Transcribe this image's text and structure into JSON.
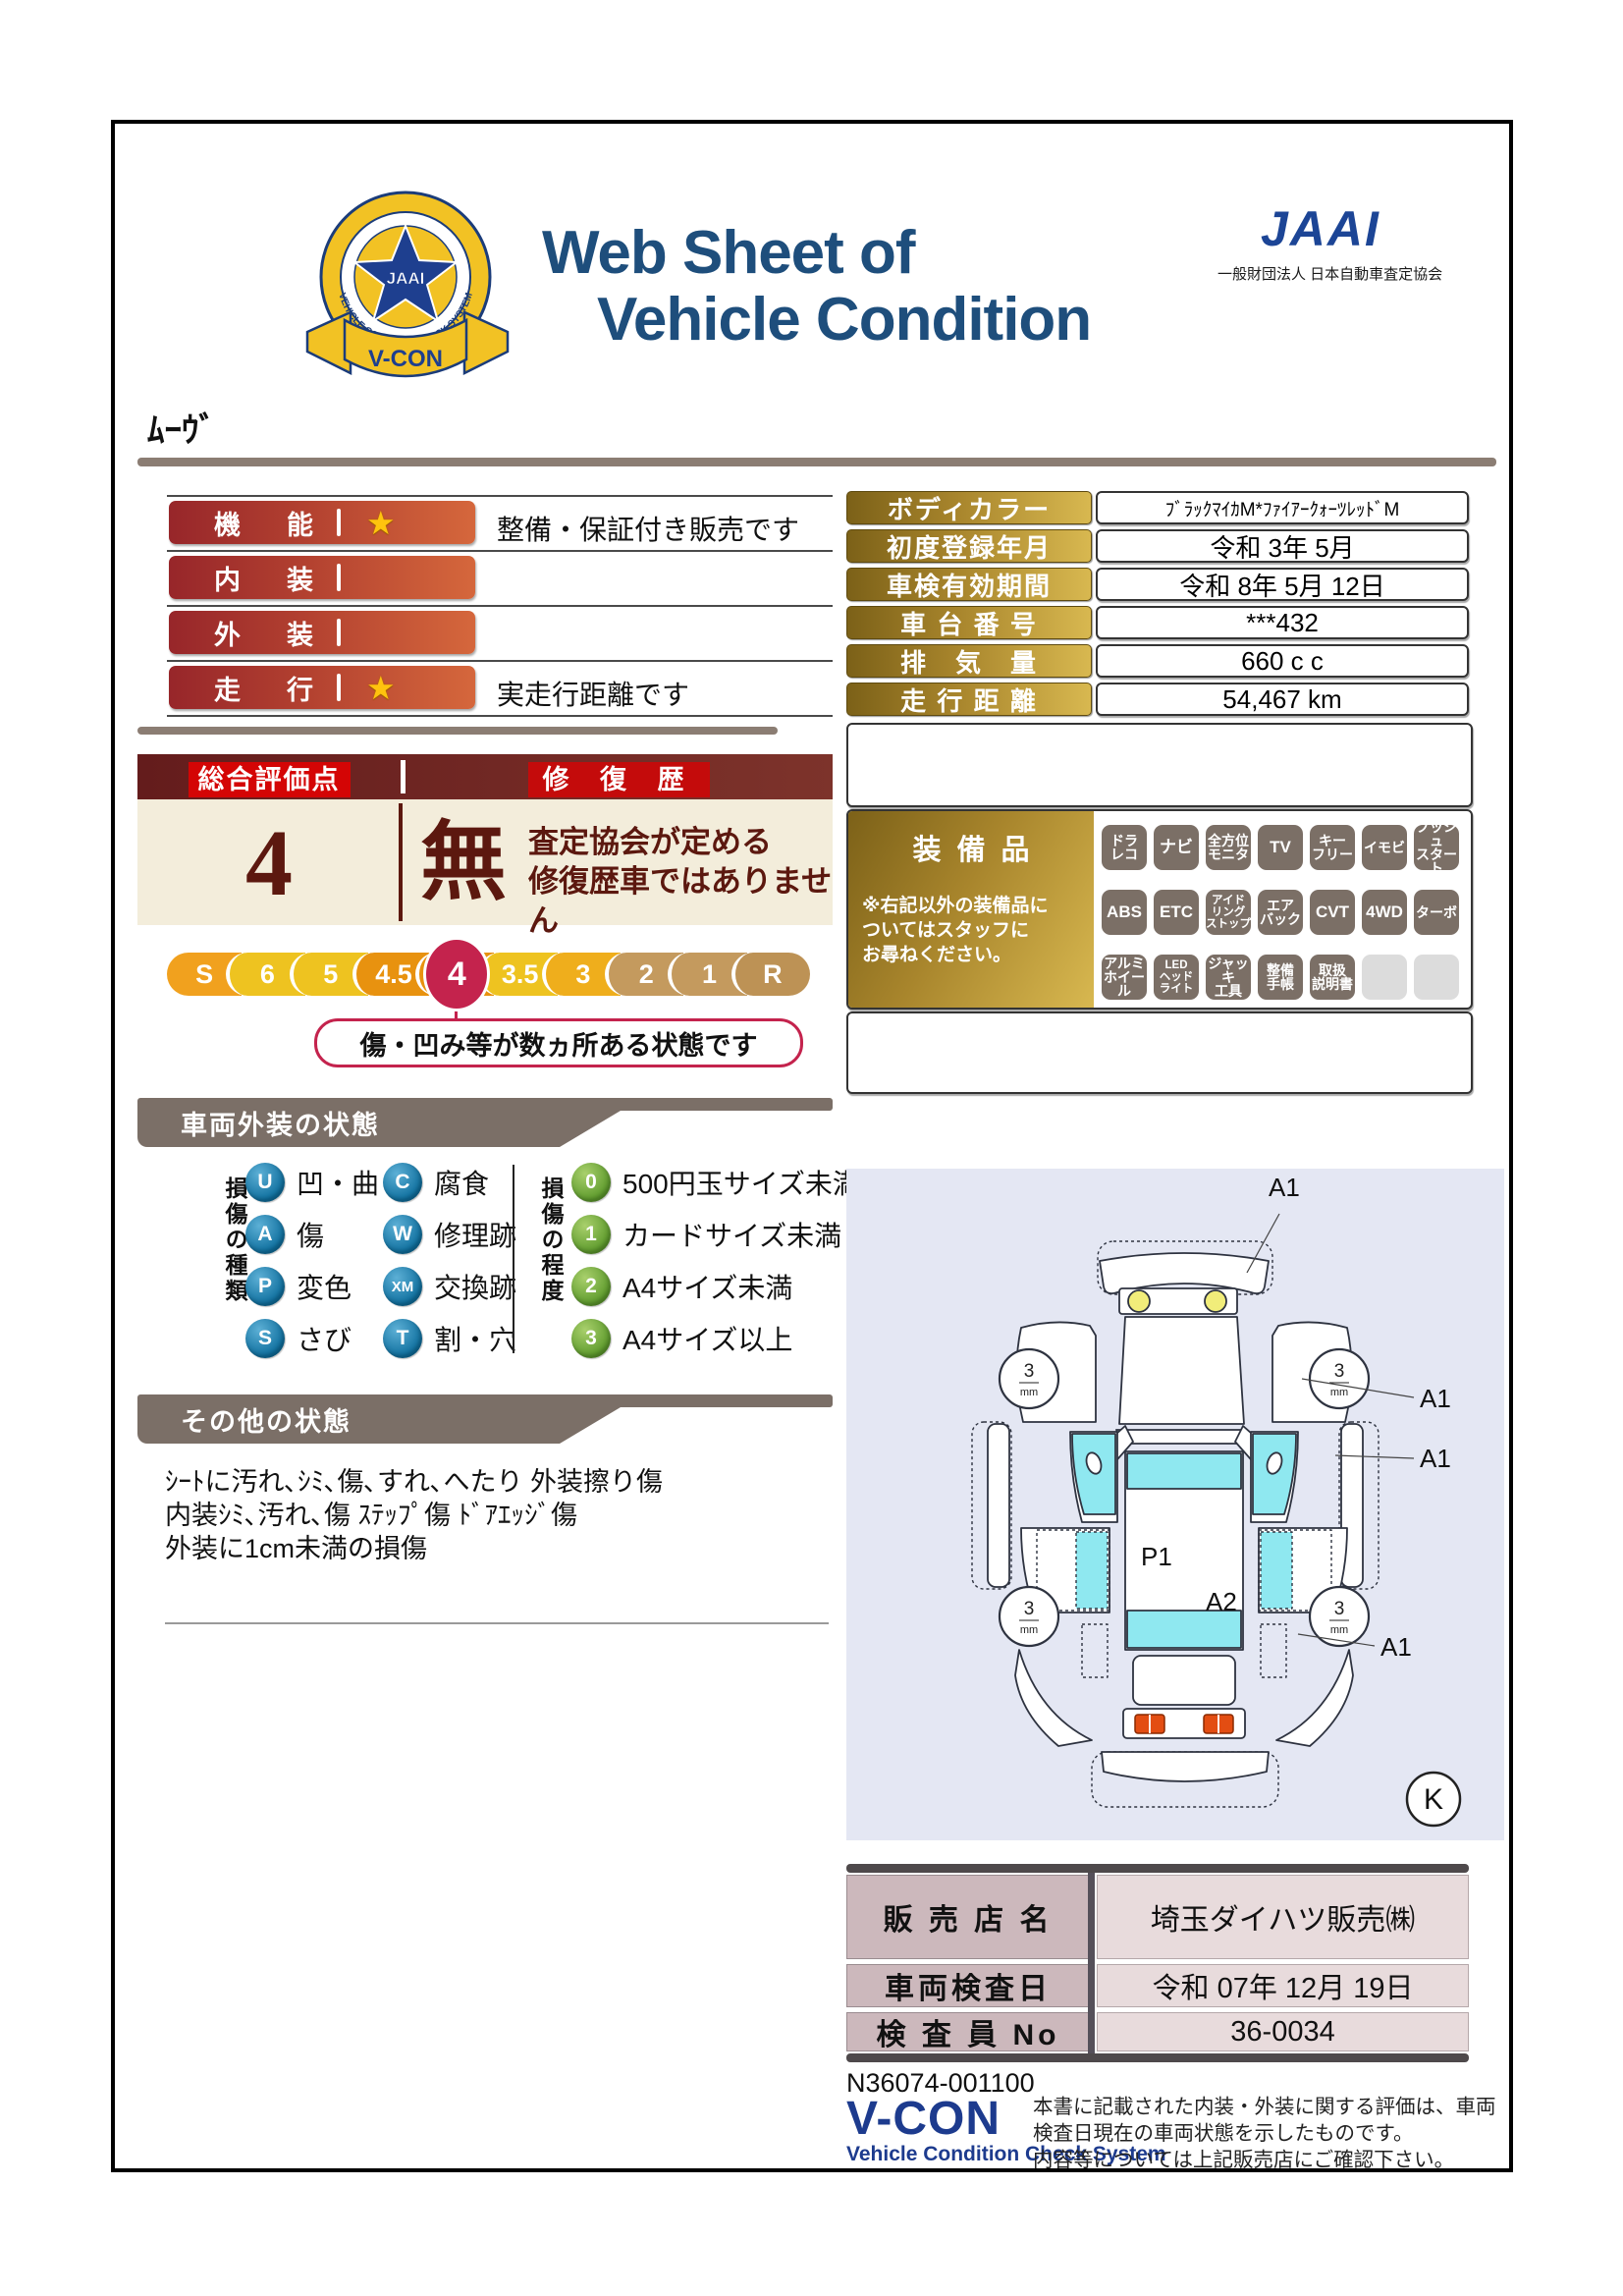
{
  "header": {
    "title_line1": "Web Sheet of",
    "title_line2": "Vehicle Condition",
    "jaai_logo": "JAAI",
    "jaai_subtitle": "一般財団法人 日本自動車査定協会",
    "emblem": {
      "star_text": "JAAI",
      "ring_text": "VEHICLE CONDITION CHECK SYSTEM",
      "ribbon": "V-CON"
    }
  },
  "vehicle_name": "ﾑｰｳﾞ",
  "rating_bars": {
    "rows": [
      {
        "label": "機　能",
        "star": true,
        "note": "整備・保証付き販売です"
      },
      {
        "label": "内　装",
        "star": false,
        "note": ""
      },
      {
        "label": "外　装",
        "star": false,
        "note": ""
      },
      {
        "label": "走　行",
        "star": true,
        "note": "実走行距離です"
      }
    ]
  },
  "info_table": {
    "rows": [
      {
        "label": "ボディカラー",
        "value": "ﾌﾞﾗｯｸﾏｲｶM*ﾌｧｲｱｰｸｫｰﾂﾚｯﾄﾞM"
      },
      {
        "label": "初度登録年月",
        "value": "令和 3年 5月"
      },
      {
        "label": "車検有効期間",
        "value": "令和 8年 5月 12日"
      },
      {
        "label": "車 台 番 号",
        "value": "***432"
      },
      {
        "label": "排　気　量",
        "value": "660 c c"
      },
      {
        "label": "走 行 距 離",
        "value": "54,467 km"
      }
    ]
  },
  "equipment": {
    "title": "装備品",
    "note": "※右記以外の装備品に\nついてはスタッフに\nお尋ねください。",
    "badges": [
      "ドラ\nレコ",
      "ナビ",
      "全方位\nモニタ",
      "TV",
      "キー\nフリー",
      "イモビ",
      "プッシュ\nスタート",
      "ABS",
      "ETC",
      "アイド\nリング\nストップ",
      "エア\nバック",
      "CVT",
      "4WD",
      "ターボ",
      "アルミ\nホイール",
      "LED\nヘッド\nライト",
      "ジャッキ\n工具",
      "整備\n手帳",
      "取扱\n説明書",
      "",
      ""
    ]
  },
  "score": {
    "header_left": "総合評価点",
    "header_right": "修 復 歴",
    "value": "4",
    "repair": "無",
    "repair_note": "査定協会が定める\n修復歴車ではありません",
    "scale": [
      "S",
      "6",
      "5",
      "4.5",
      "4",
      "3.5",
      "3",
      "2",
      "1",
      "R"
    ],
    "selected": "4",
    "callout": "傷・凹み等が数ヵ所ある状態です"
  },
  "exterior": {
    "banner": "車両外装の状態",
    "type_label": "損傷の種類",
    "types": [
      {
        "code": "U",
        "label": "凹・曲"
      },
      {
        "code": "A",
        "label": "傷"
      },
      {
        "code": "P",
        "label": "変色"
      },
      {
        "code": "S",
        "label": "さび"
      },
      {
        "code": "C",
        "label": "腐食"
      },
      {
        "code": "W",
        "label": "修理跡"
      },
      {
        "code": "XM",
        "label": "交換跡"
      },
      {
        "code": "T",
        "label": "割・穴"
      }
    ],
    "degree_label": "損傷の程度",
    "degrees": [
      {
        "code": "0",
        "label": "500円玉サイズ未満"
      },
      {
        "code": "1",
        "label": "カードサイズ未満"
      },
      {
        "code": "2",
        "label": "A4サイズ未満"
      },
      {
        "code": "3",
        "label": "A4サイズ以上"
      }
    ]
  },
  "other": {
    "banner": "その他の状態",
    "text": "ｼｰﾄに汚れ､ｼﾐ､傷､すれ､へたり 外装擦り傷\n内装ｼﾐ､汚れ､傷 ｽﾃｯﾌﾟ傷 ﾄﾞｱｴｯｼﾞ傷\n外装に1cm未満の損傷"
  },
  "diagram": {
    "p1": "P1",
    "a2": "A2",
    "a1_labels": [
      "A1",
      "A1",
      "A1",
      "A1"
    ],
    "wheel_value": "3",
    "wheel_unit": "mm",
    "k": "K"
  },
  "dealer_table": {
    "rows": [
      {
        "label": "販 売 店 名",
        "value": "埼玉ダイハツ販売㈱"
      },
      {
        "label": "車両検査日",
        "value": "令和 07年 12月 19日"
      },
      {
        "label": "検 査 員 No",
        "value": "36-0034"
      }
    ]
  },
  "footer": {
    "code": "N36074-001100",
    "vcon": "V-CON",
    "vcon_sub": "Vehicle Condition Check System",
    "note": "本書に記載された内装・外装に関する評価は、車両\n検査日現在の車両状態を示したものです。\n内容等については上記販売店にご確認下さい。"
  },
  "colors": {
    "navy_title": "#1E4E7C",
    "jaai_blue": "#1C4596",
    "gold_dark": "#7c6118",
    "gold_light": "#d8b850",
    "bar_red_left": "#97262a",
    "bar_red_right": "#d5673c",
    "maroon_header": "#641c1c",
    "cream": "#f3eddb",
    "crimson": "#c4234d",
    "banner_gray": "#7b6f67",
    "badge_gray": "#7b6f66",
    "type_blue": "#0f6f9e",
    "degree_green": "#5d9a2c",
    "panel_lavender": "#e4e7f3",
    "dealer_label_pink": "#ccb8bc",
    "dealer_value_pink": "#e8dbdc",
    "vcon_navy": "#1d3b8e",
    "cyan_glass": "#8FE8F0"
  }
}
